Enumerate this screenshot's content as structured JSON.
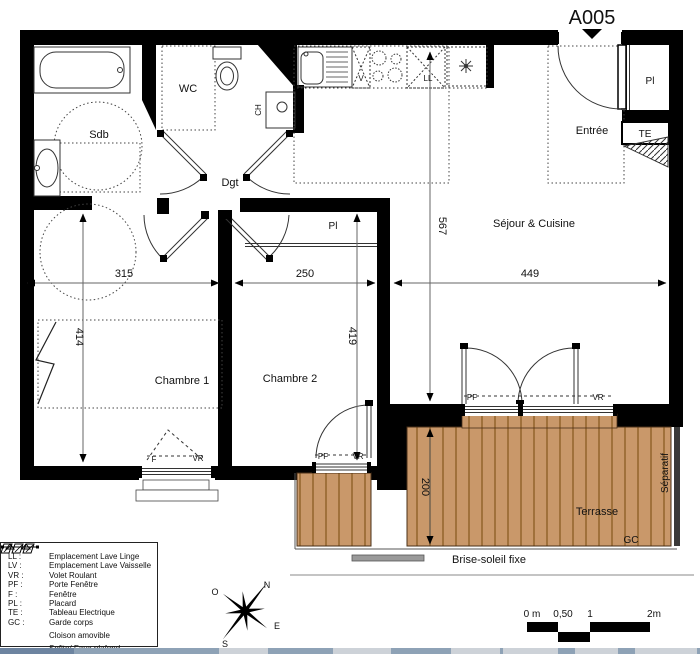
{
  "title": "A005",
  "rooms": {
    "bathroom": "Sdb",
    "wc": "WC",
    "hallway": "Dgt",
    "entry": "Entrée",
    "living_kitchen": "Séjour & Cuisine",
    "bedroom1": "Chambre 1",
    "bedroom2": "Chambre 2",
    "terrace": "Terrasse"
  },
  "dimensions_cm": {
    "bedroom1_width": "315",
    "bedroom2_width": "250",
    "living_width": "449",
    "living_depth": "567",
    "bedroom1_depth": "414",
    "bedroom2_depth": "419",
    "terrace_depth": "200"
  },
  "labels": {
    "placard": "Pl",
    "electrical_panel": "TE",
    "water_heater": "CH",
    "dishwasher": "V",
    "washing_machine": "LL",
    "window": "F",
    "roller_shutter": "VR",
    "french_window": "PF",
    "guard_rail": "GC",
    "separator": "Séparatif",
    "fixed_sunshade": "Brise-soleil fixe"
  },
  "legend": {
    "items": [
      {
        "key": "LL :",
        "value": "Emplacement Lave Linge"
      },
      {
        "key": "LV :",
        "value": "Emplacement Lave Vaisselle"
      },
      {
        "key": "VR :",
        "value": "Volet Roulant"
      },
      {
        "key": "PF :",
        "value": "Porte Fenêtre"
      },
      {
        "key": "F :",
        "value": "Fenêtre"
      },
      {
        "key": "PL :",
        "value": "Placard"
      },
      {
        "key": "TE :",
        "value": "Tableau Electrique"
      },
      {
        "key": "GC :",
        "value": "Garde corps"
      },
      {
        "key": "",
        "value": "Cloison amovible"
      },
      {
        "key": "",
        "value": "Sofite/ Faux plafond"
      }
    ]
  },
  "compass": {
    "n": "N",
    "o": "O",
    "e": "E",
    "s": "S"
  },
  "scale_bar": {
    "zero": "0 m",
    "half": "0,50",
    "one": "1",
    "two": "2m"
  },
  "colors": {
    "wall": "#000000",
    "deck_fill": "#c9986a",
    "deck_plank_line": "#96672f",
    "dim_line": "#666666",
    "sunshade_bar": "#9a9a9a",
    "taskbar_strip": "#8ea2b6"
  }
}
